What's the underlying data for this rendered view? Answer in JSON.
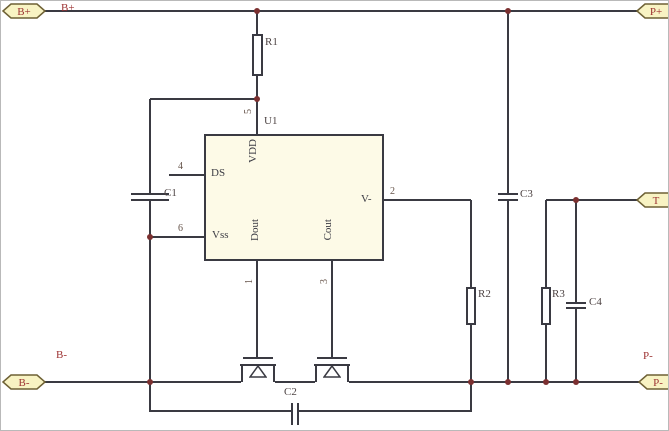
{
  "colors": {
    "wire": "#3a3a42",
    "junction": "#7b3030",
    "net": "#9d3232",
    "des": "#4e4444",
    "pinnum": "#655349",
    "pinname": "#3c3c44",
    "tagfill": "#f8f3c3",
    "tagborder": "#6e6135",
    "chipfill": "#fdfae7",
    "bg": "#ffffff",
    "frame": "#b9b9b9"
  },
  "ports": {
    "b_plus": "B+",
    "p_plus": "P+",
    "b_minus": "B-",
    "p_minus": "P-",
    "t": "T"
  },
  "net_labels": {
    "b_plus": "B+",
    "b_minus": "B-",
    "p_minus": "P-"
  },
  "ic": {
    "designator": "U1",
    "pin_numbers": {
      "vdd": "5",
      "ds": "4",
      "vss": "6",
      "dout": "1",
      "cout": "3",
      "v_minus": "2"
    },
    "pin_names": {
      "vdd": "VDD",
      "ds": "DS",
      "vss": "Vss",
      "dout": "Dout",
      "cout": "Cout",
      "v_minus": "V-"
    }
  },
  "designators": {
    "r1": "R1",
    "r2": "R2",
    "r3": "R3",
    "c1": "C1",
    "c2": "C2",
    "c3": "C3",
    "c4": "C4"
  }
}
